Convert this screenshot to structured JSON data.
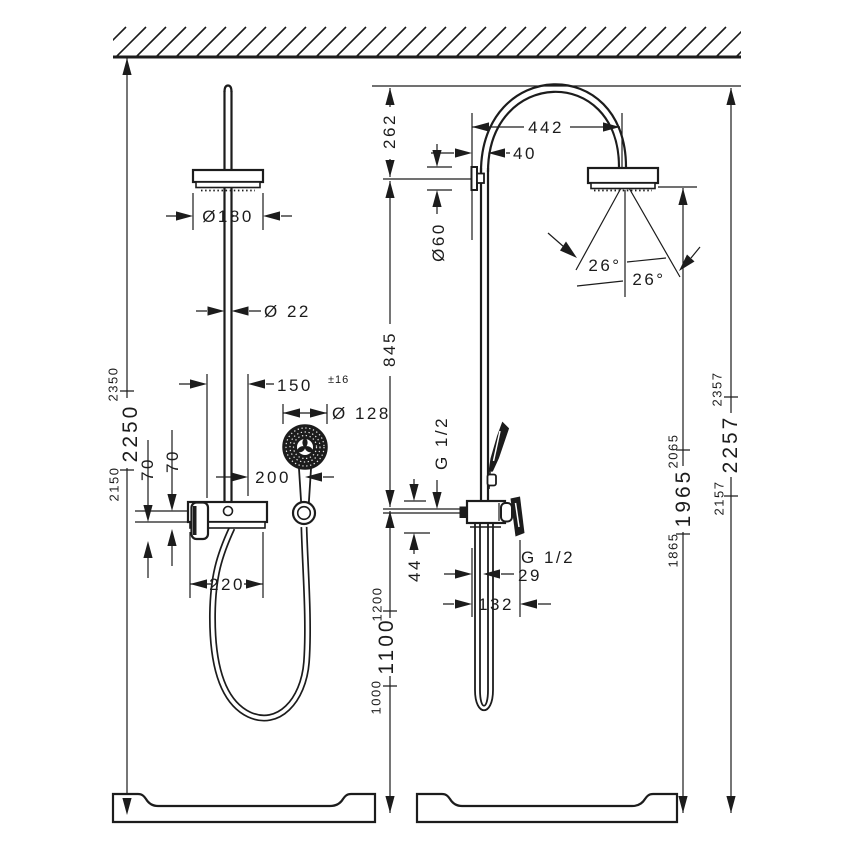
{
  "drawing": {
    "type": "shower-system installation drawing, front and side view with dimensions (mm)"
  },
  "left_view": {
    "head_diameter": "Ø180",
    "pipe_diameter": "Ø 22",
    "connection_width": "150",
    "connection_tolerance": "±16",
    "hand_shower_diameter": "Ø 128",
    "holder_offset": "200",
    "offset_70_inner": "70",
    "offset_70_outer": "70",
    "mixer_width": "220",
    "ceiling_heights": {
      "top": "2350",
      "main": "2250",
      "bottom": "2150"
    }
  },
  "right_view": {
    "arc_height": "262",
    "arc_reach": "442",
    "wall_offset": "40",
    "flange_diameter": "Ø60",
    "spray_angle_left": "26°",
    "spray_angle_right": "26°",
    "head_to_supply": "845",
    "inlet_thread": "G 1/2",
    "inlet_drop": "44",
    "outlet_thread": "G 1/2",
    "hose_offset": "29",
    "mixer_depth": "132",
    "hose_heights": {
      "top": "1200",
      "main": "1100",
      "bottom": "1000"
    },
    "head_heights": {
      "top": "2065",
      "main": "1965",
      "bottom": "1865"
    },
    "total_heights": {
      "top": "2357",
      "main": "2257",
      "bottom": "2157"
    }
  }
}
